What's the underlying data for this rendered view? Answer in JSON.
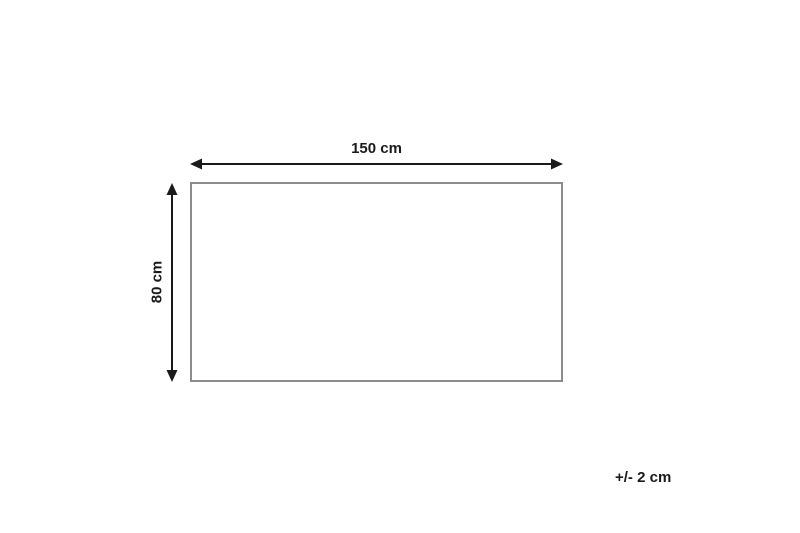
{
  "diagram": {
    "type": "product-dimension-diagram",
    "width_label": "150 cm",
    "height_label": "80 cm",
    "tolerance_label": "+/- 2 cm",
    "colors": {
      "background": "#ffffff",
      "arrow": "#1a1a1a",
      "text": "#1a1a1a",
      "rectangle_border": "#8c8c8c"
    }
  }
}
